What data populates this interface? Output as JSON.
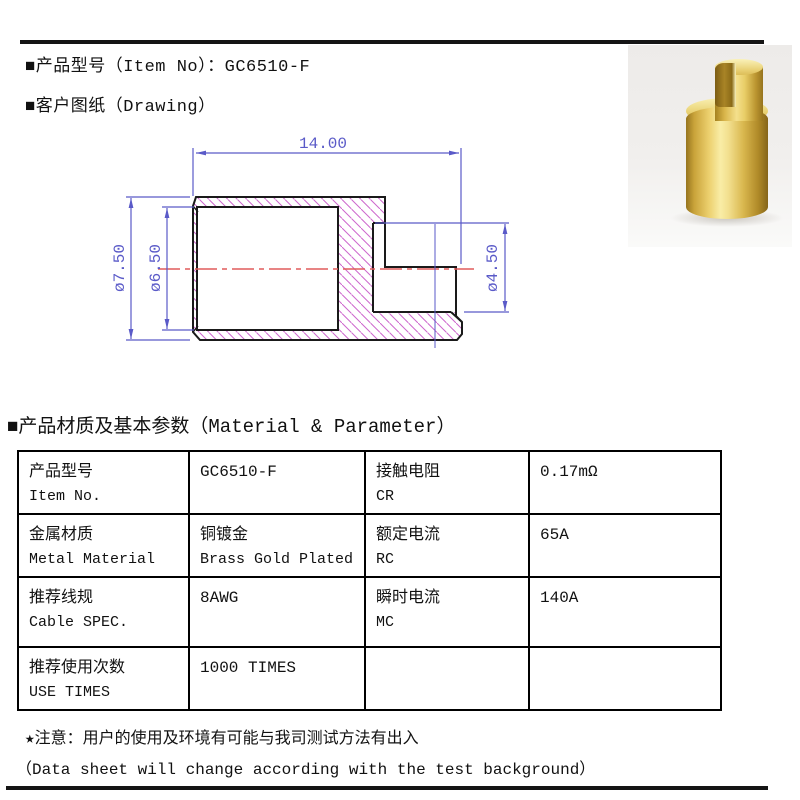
{
  "header": {
    "item_line": "■产品型号（Item No）：GC6510-F",
    "drawing_line": "■客户图纸（Drawing）"
  },
  "drawing": {
    "dim_length": "14.00",
    "dim_outer_dia": "ø7.50",
    "dim_bore_dia": "ø6.50",
    "dim_tip_dia": "ø4.50"
  },
  "materials": {
    "title": "■产品材质及基本参数（Material & Parameter）"
  },
  "table": {
    "rows": [
      [
        {
          "l1": "产品型号",
          "l2": "Item No."
        },
        {
          "l1": "GC6510-F",
          "l2": ""
        },
        {
          "l1": "接触电阻",
          "l2": "CR"
        },
        {
          "l1": "0.17mΩ",
          "l2": ""
        }
      ],
      [
        {
          "l1": "金属材质",
          "l2": "Metal Material"
        },
        {
          "l1": "铜镀金",
          "l2": "Brass Gold Plated"
        },
        {
          "l1": "额定电流",
          "l2": "RC"
        },
        {
          "l1": "65A",
          "l2": ""
        }
      ],
      [
        {
          "l1": "推荐线规",
          "l2": "Cable SPEC."
        },
        {
          "l1": "8AWG",
          "l2": ""
        },
        {
          "l1": "瞬时电流",
          "l2": "MC"
        },
        {
          "l1": "140A",
          "l2": ""
        }
      ],
      [
        {
          "l1": "推荐使用次数",
          "l2": "USE TIMES"
        },
        {
          "l1": "1000 TIMES",
          "l2": ""
        },
        {
          "l1": "",
          "l2": ""
        },
        {
          "l1": "",
          "l2": ""
        }
      ]
    ]
  },
  "notes": {
    "line1": "★注意：用户的使用及环境有可能与我司测试方法有出入",
    "line2": "（Data sheet will change according with the test background）"
  },
  "colors": {
    "dimension_blue": "#5a5ac8",
    "hatch_magenta": "#cc66cc",
    "centerline_red": "#e05c5c",
    "outline_black": "#1a1a1a",
    "gold_base": "#d9b74e"
  }
}
